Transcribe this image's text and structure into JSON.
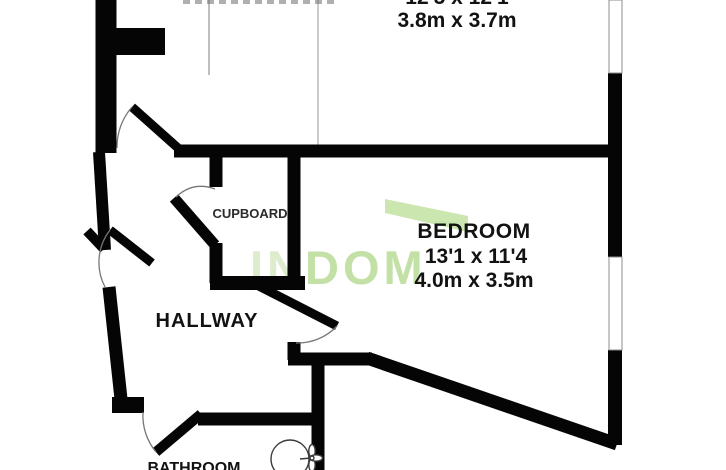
{
  "rooms": {
    "reception": {
      "dims_imperial": "12'5 x 12'1",
      "dims_metric": "3.8m x 3.7m"
    },
    "bedroom": {
      "label": "BEDROOM",
      "dims_imperial": "13'1 x 11'4",
      "dims_metric": "4.0m x 3.5m"
    },
    "cupboard": {
      "label": "CUPBOARD"
    },
    "hallway": {
      "label": "HALLWAY"
    },
    "bathroom": {
      "label": "BATHROOM"
    }
  },
  "watermark": {
    "prefix": "IN",
    "suffix": "DOM",
    "letter_color": "#c3e1a6",
    "light_color": "#dceccd",
    "roof_color": "#cbe6af"
  },
  "colors": {
    "wall": "#050505",
    "label": "#121212",
    "background": "#ffffff"
  }
}
